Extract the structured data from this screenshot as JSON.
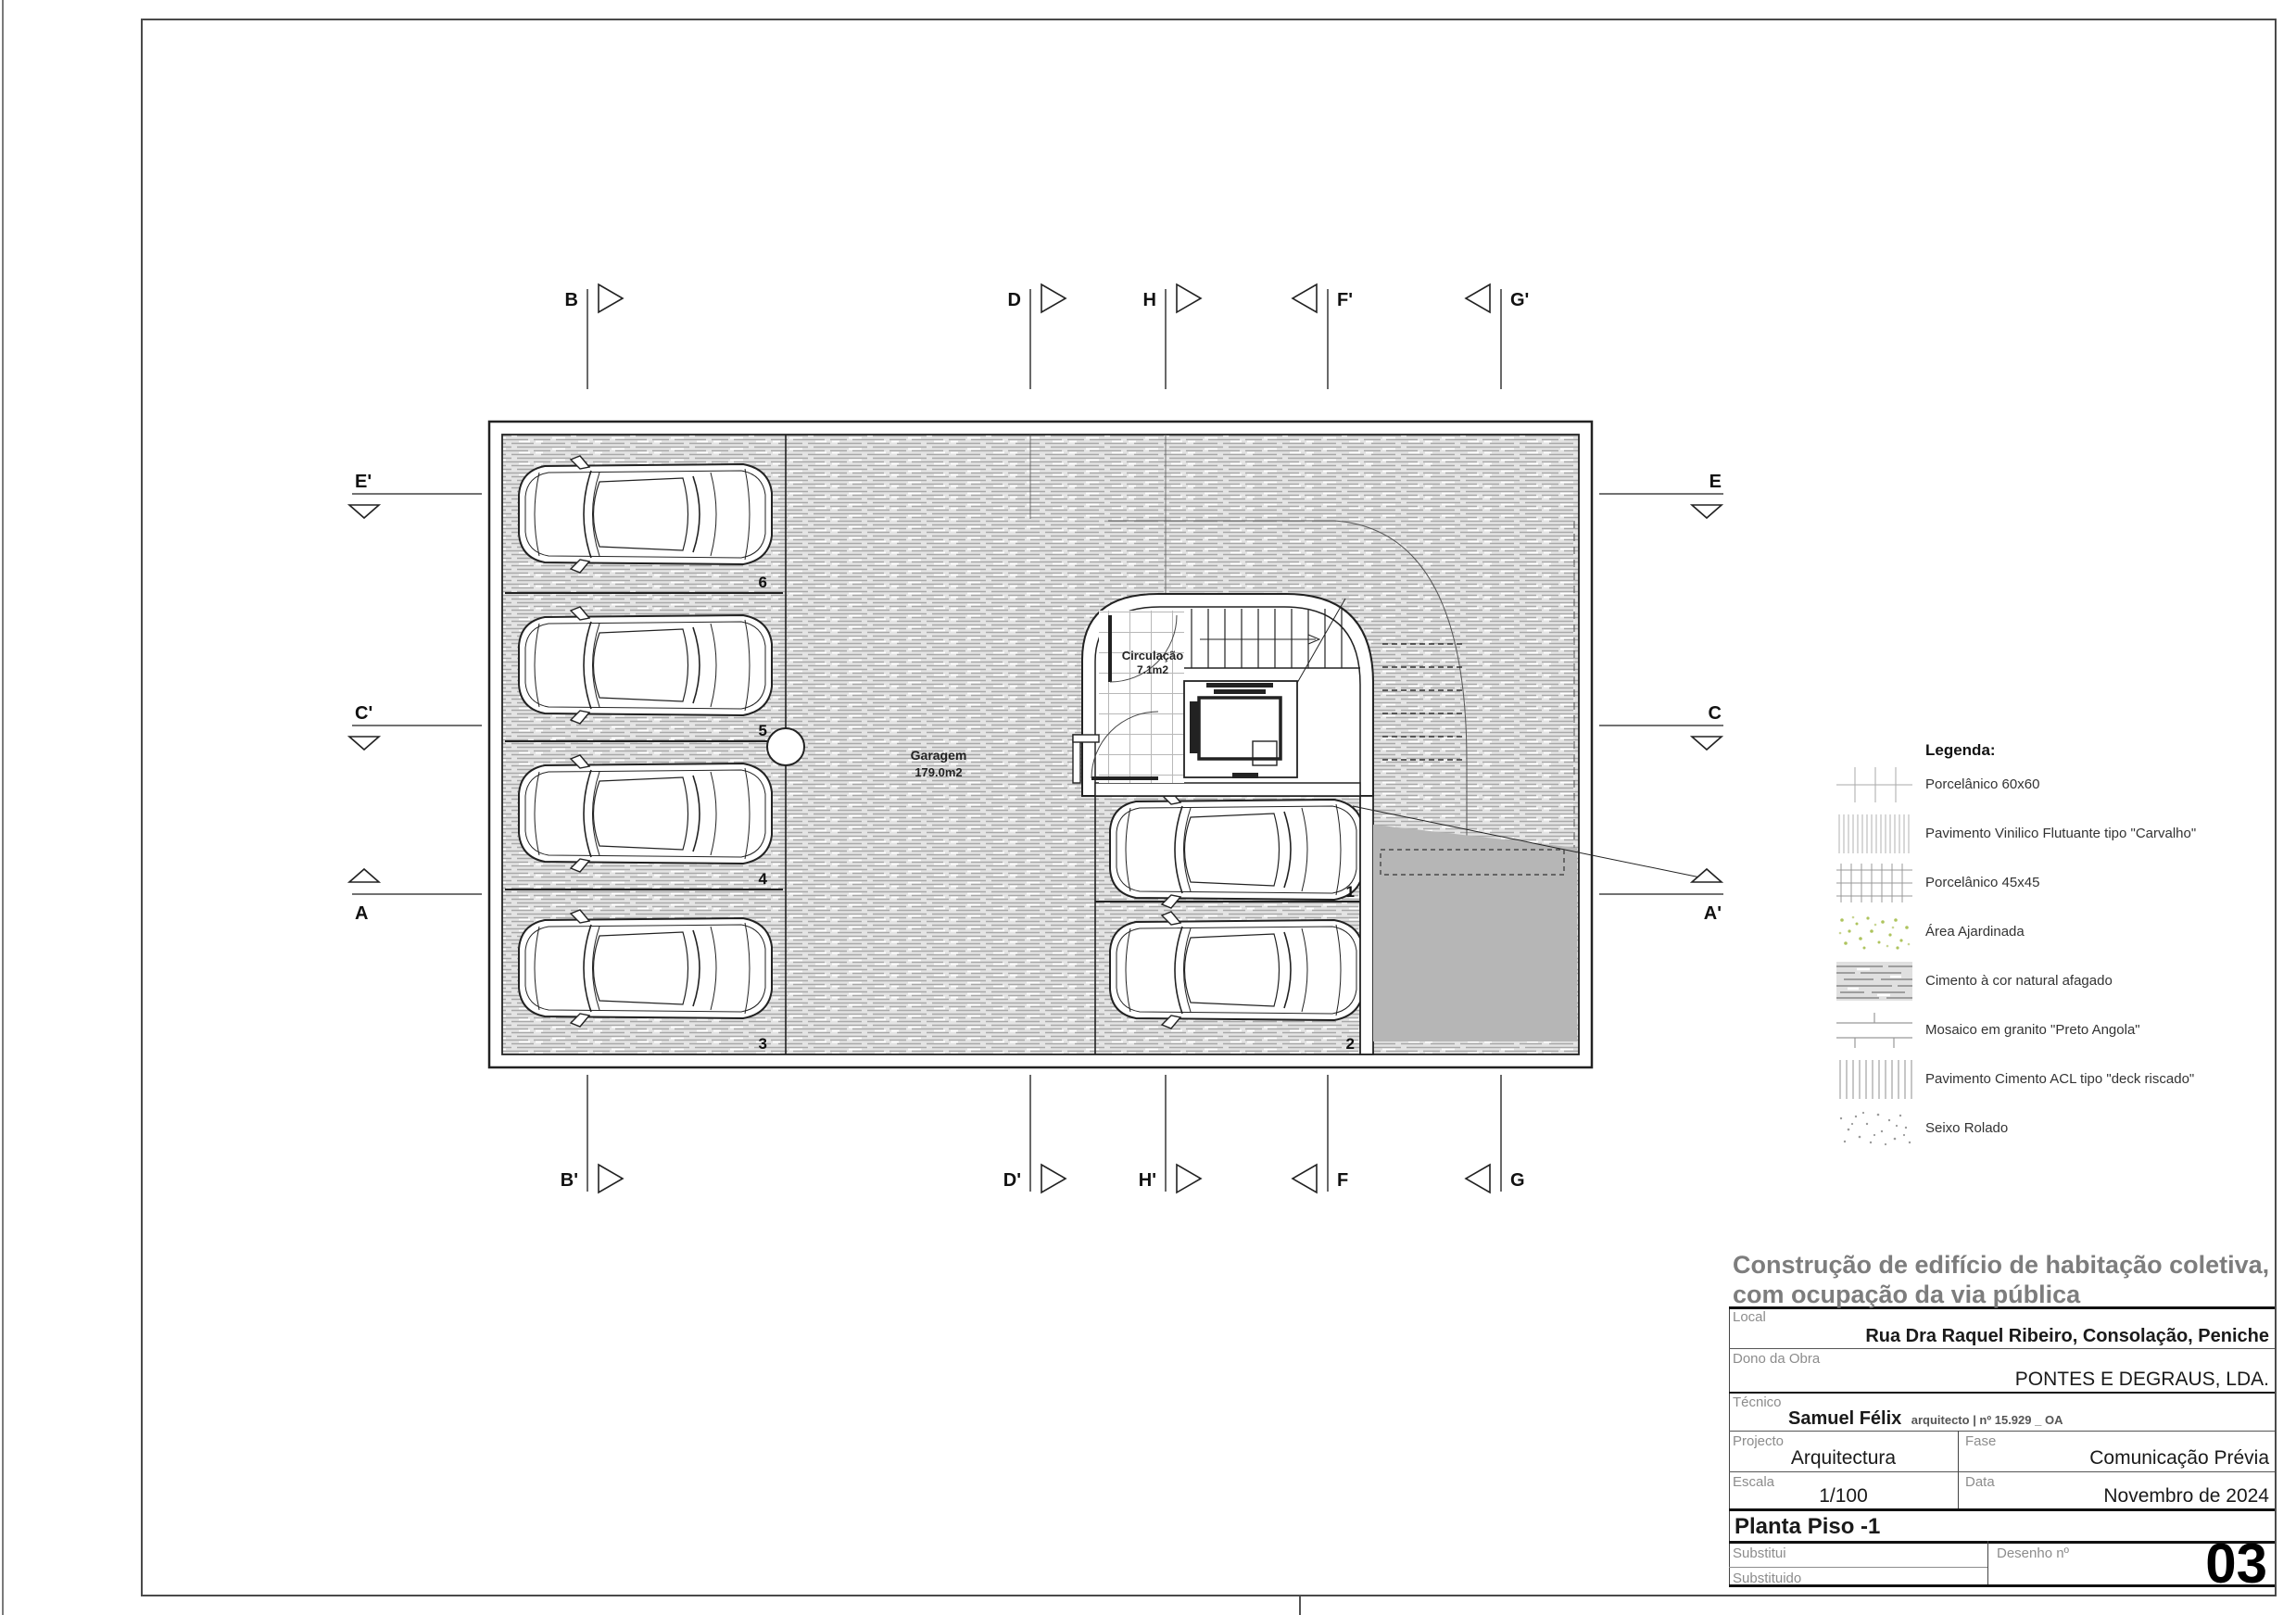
{
  "colors": {
    "line": "#1a1a1a",
    "muted_label": "#8c8c8c",
    "ramp_fill": "#b6b6b6",
    "garden_green": "#aec45e",
    "hatch_gray": "#a8a8a8"
  },
  "plan": {
    "garage_label": "Garagem",
    "garage_area": "179.0m2",
    "circulation_label": "Circulação",
    "circulation_area": "7.1m2",
    "parking_spaces": [
      "1",
      "2",
      "3",
      "4",
      "5",
      "6"
    ],
    "section_markers": {
      "top": [
        "B",
        "D",
        "H",
        "F'",
        "G'"
      ],
      "bottom": [
        "B'",
        "D'",
        "H'",
        "F",
        "G"
      ],
      "left": [
        "E'",
        "C'",
        "A"
      ],
      "right": [
        "E",
        "C",
        "A'"
      ]
    }
  },
  "legend": {
    "header": "Legenda:",
    "items": [
      {
        "icon": "porcelain-60x60-swatch",
        "label": "Porcelânico 60x60"
      },
      {
        "icon": "vinyl-floating-floor-swatch",
        "label": "Pavimento Vinilico Flutuante tipo \"Carvalho\""
      },
      {
        "icon": "porcelain-45x45-swatch",
        "label": "Porcelânico 45x45"
      },
      {
        "icon": "garden-area-swatch",
        "label": "Área Ajardinada"
      },
      {
        "icon": "natural-cement-swatch",
        "label": "Cimento à cor natural afagado"
      },
      {
        "icon": "granite-mosaic-swatch",
        "label": "Mosaico em granito \"Preto Angola\""
      },
      {
        "icon": "acl-cement-deck-swatch",
        "label": "Pavimento Cimento ACL tipo \"deck riscado\""
      },
      {
        "icon": "rolled-pebble-swatch",
        "label": "Seixo Rolado"
      }
    ]
  },
  "title_block": {
    "project_title_line1": "Construção de edifício de habitação coletiva,",
    "project_title_line2": "com ocupação da via pública",
    "local_label": "Local",
    "local_value": "Rua Dra Raquel Ribeiro, Consolação, Peniche",
    "owner_label": "Dono da Obra",
    "owner_value": "PONTES E DEGRAUS, LDA.",
    "technician_label": "Técnico",
    "technician_name": "Samuel Félix",
    "technician_credentials": "arquitecto | nº 15.929 _ OA",
    "project_label": "Projecto",
    "project_value": "Arquitectura",
    "phase_label": "Fase",
    "phase_value": "Comunicação Prévia",
    "scale_label": "Escala",
    "scale_value": "1/100",
    "date_label": "Data",
    "date_value": "Novembro de 2024",
    "drawing_name": "Planta Piso -1",
    "substitutes_label": "Substitui",
    "substituted_label": "Substituido",
    "drawing_number_label": "Desenho nº",
    "drawing_number": "03"
  }
}
